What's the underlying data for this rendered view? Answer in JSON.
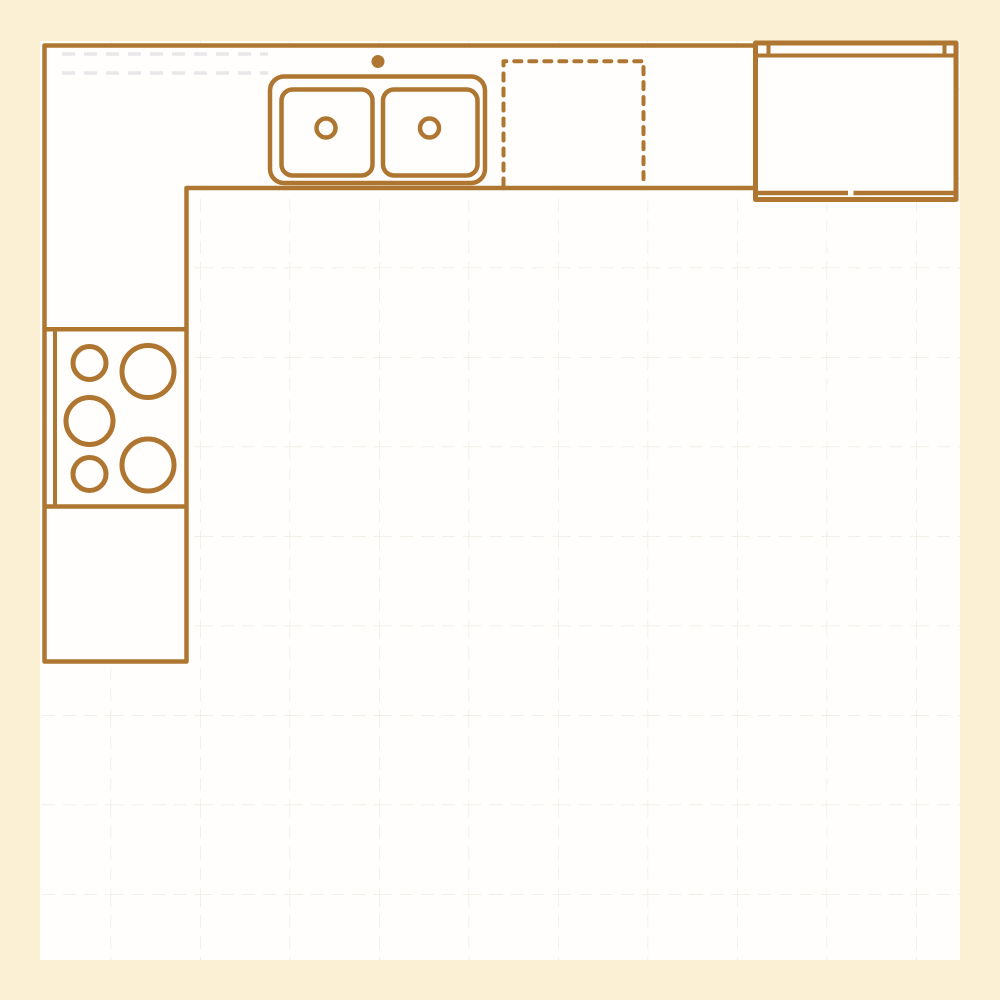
{
  "colors": {
    "cream": "#fcf0d4",
    "floor": "#fffefc",
    "line": "#ae7630",
    "grid": "#edebe2",
    "ghost": "#e9e7ea"
  },
  "floor_plan": {
    "grid_spacing_px": 90,
    "layout": "L-shaped kitchen counter along top and left walls",
    "elements": [
      {
        "id": "countertop-run",
        "kind": "l-shaped-countertop"
      },
      {
        "id": "wall-cabinet-ghost",
        "kind": "faint-wall-cabinet-outline"
      },
      {
        "id": "sink",
        "kind": "double-basin-sink",
        "basins": 2,
        "drains": 2,
        "faucet_dot": true
      },
      {
        "id": "dishwasher-placeholder",
        "kind": "dashed-appliance-outline"
      },
      {
        "id": "refrigerator",
        "kind": "double-door-refrigerator"
      },
      {
        "id": "cooktop",
        "kind": "burner-cooktop",
        "burners": 5
      },
      {
        "id": "base-cabinet",
        "kind": "base-cabinet-section"
      }
    ]
  }
}
